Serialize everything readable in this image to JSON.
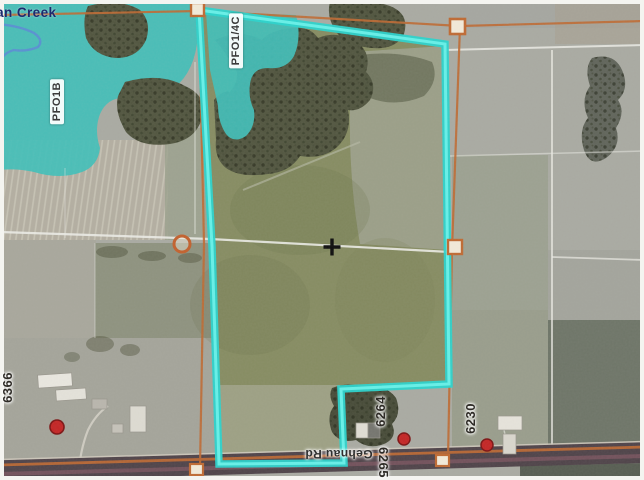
{
  "map": {
    "creek_label": "ian Creek",
    "wetland_label_1": "PFO1B",
    "wetland_label_2": "PFO1/4C",
    "road_label": "Gehnau Rd",
    "address_6366": "6366",
    "address_6264": "6264",
    "address_6230": "6230",
    "address_6265": "6265",
    "colors": {
      "parcel_boundary_cyan": "#2bd3cc",
      "wetland_overlay_teal": "#41bfb9",
      "parcel_line_orange": "#bf6a33",
      "selected_marker_red": "#c32525",
      "creek_label_blue": "#1d2a6e",
      "section_line_white": "#ebebe5",
      "road_dark": "#4f4349"
    }
  }
}
